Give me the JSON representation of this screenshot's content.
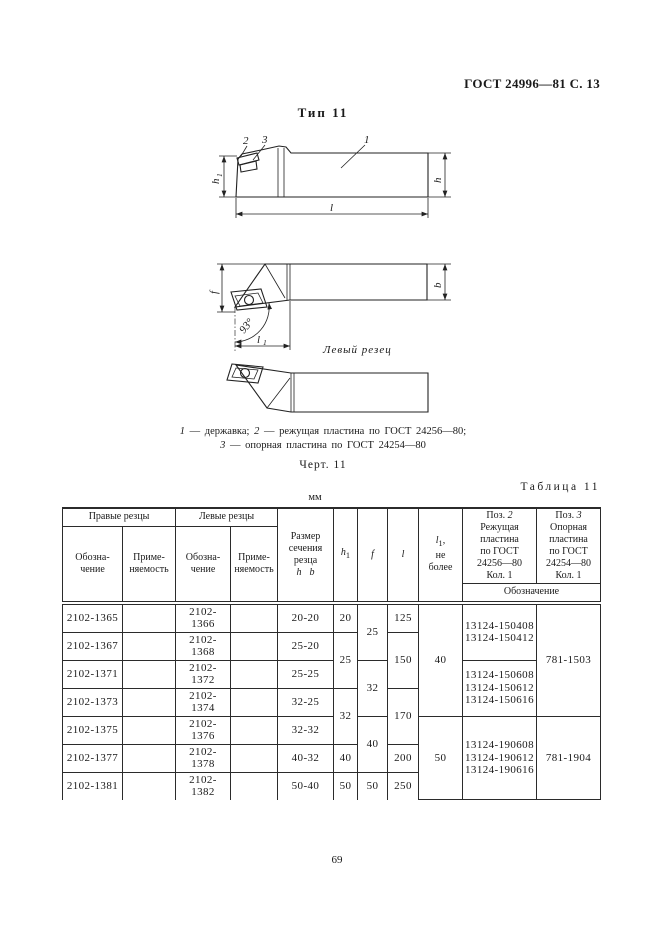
{
  "page": {
    "header": "ГОСТ 24996—81 С. 13",
    "type_title": "Тип 11",
    "figure_number": "Черт. 11",
    "page_number": "69",
    "left_cutter_label": "Левый резец"
  },
  "caption": {
    "n1": "1",
    "t1": " — державка; ",
    "n2": "2",
    "t2": " — режущая пластина по ГОСТ 24256—80;",
    "n3": "3",
    "t3": " — опорная  пластина по ГОСТ 24254—80"
  },
  "drawing": {
    "part1": "1",
    "part2": "2",
    "part3": "3",
    "h1_base": "h",
    "h1_sub": "1",
    "h": "h",
    "l": "l",
    "f": "f",
    "b": "b",
    "angle": "93°",
    "l1_base": "l",
    "l1_sub": "1"
  },
  "table": {
    "caption": "Таблица 11",
    "units": "мм",
    "head": {
      "right_group": "Правые резцы",
      "left_group": "Левые резцы",
      "designation": "Обозна-\nчение",
      "usage": "Приме-\nняемость",
      "size": "Размер\nсечения\nрезца",
      "size_h": "h",
      "size_b": "b",
      "h1_base": "h",
      "h1_sub": "1",
      "f": "f",
      "l": "l",
      "l1_base": "l",
      "l1_sub": "1",
      "l1_comma": ",",
      "l1_rest": "не\nболее",
      "pos2_label": "Поз. ",
      "pos2_num": "2",
      "pos2_rest": "Режущая\nпластина\nпо ГОСТ\n24256—80\nКол. 1",
      "pos3_label": "Поз. ",
      "pos3_num": "3",
      "pos3_rest": "Опорная\nпластина\nпо ГОСТ\n24254—80\nКол. 1",
      "designation2": "Обозначение"
    },
    "rows": {
      "r1": {
        "right": "2102-1365",
        "left": "2102-1366",
        "size": "20-20",
        "h1": "20",
        "f": "25",
        "l": "125",
        "l1": "40",
        "cut": "13124-150408\n13124-150412",
        "sup": "781-1503"
      },
      "r2": {
        "right": "2102-1367",
        "left": "2102-1368",
        "size": "25-20",
        "h1": "25",
        "l": "150"
      },
      "r3": {
        "right": "2102-1371",
        "left": "2102-1372",
        "size": "25-25",
        "f": "32",
        "cut": "13124-150608\n13124-150612\n13124-150616"
      },
      "r4": {
        "right": "2102-1373",
        "left": "2102-1374",
        "size": "32-25",
        "h1": "32",
        "l": "170"
      },
      "r5": {
        "right": "2102-1375",
        "left": "2102-1376",
        "size": "32-32",
        "f": "40",
        "l1": "50",
        "cut": "13124-190608\n13124-190612\n13124-190616",
        "sup": "781-1904"
      },
      "r6": {
        "right": "2102-1377",
        "left": "2102-1378",
        "size": "40-32",
        "h1": "40",
        "l": "200"
      },
      "r7": {
        "right": "2102-1381",
        "left": "2102-1382",
        "size": "50-40",
        "h1": "50",
        "f": "50",
        "l": "250"
      }
    }
  }
}
